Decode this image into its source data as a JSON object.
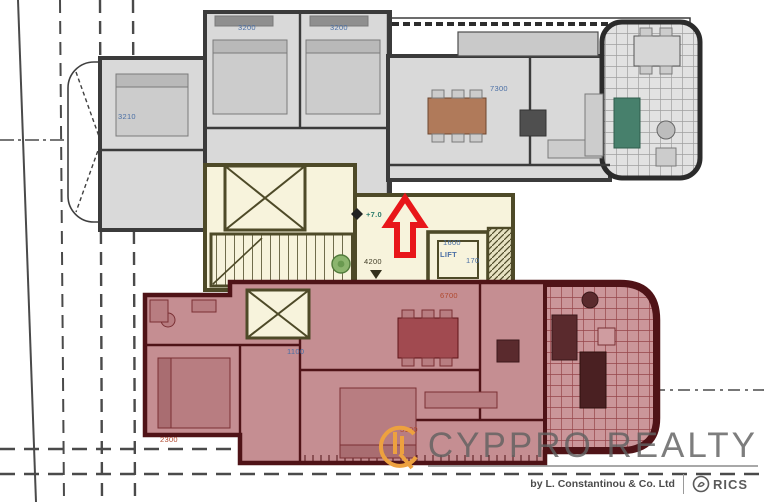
{
  "plan": {
    "upper": {
      "fill": "#d9d9d9",
      "wall_color": "#3b3b3b",
      "dim_bed_left": "3210",
      "dim_bed1": "3200",
      "dim_bed2": "3200",
      "dim_living": "7300"
    },
    "core": {
      "fill": "#f7f3dc",
      "wall_color": "#4e4a28",
      "level": "+7.0",
      "stair_dim": "4200",
      "lift_label": "LIFT",
      "lift_width": "1600",
      "lift_depth": "170"
    },
    "lower": {
      "fill": "#c58e92",
      "wall_color": "#4f1317",
      "dim_corridor": "1100",
      "dim_living": "6700",
      "dim_bed": "2300",
      "dim_kitchen": "3100"
    },
    "arrow_color": "#e8161a"
  },
  "watermark": {
    "brand": "CYPPRO REALTY",
    "byline": "by L. Constantinou & Co. Ltd",
    "rics": "RICS",
    "accent": "#eda13f",
    "text_color": "#606060"
  }
}
